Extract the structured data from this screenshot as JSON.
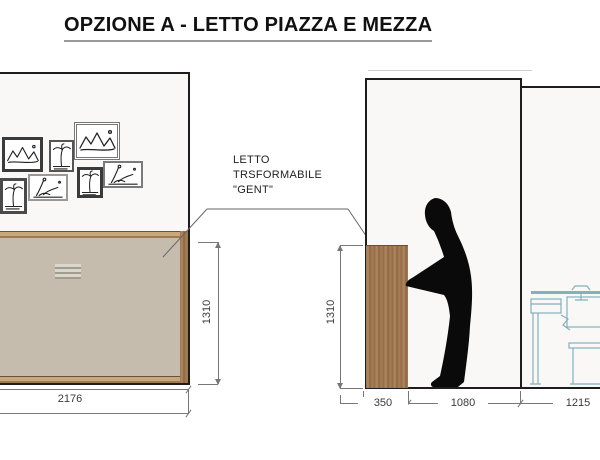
{
  "title": "OPZIONE A - LETTO PIAZZA E MEZZA",
  "annotation": {
    "lines": [
      "LETTO",
      "TRSFORMABILE",
      "\"GENT\""
    ]
  },
  "views": {
    "front_elevation": {
      "description_dims": {
        "width": "2176",
        "height": "1310"
      }
    },
    "side_elevation": {
      "description_dims": {
        "height": "1310",
        "bed_depth": "350",
        "clearance": "1080",
        "right_zone": "1215"
      }
    }
  },
  "dimensions": {
    "front_width": "2176",
    "front_height": "1310",
    "side_height": "1310",
    "side_depth": "350",
    "side_clearance": "1080",
    "side_zone": "1215"
  },
  "icons": {
    "wall_art": "framed-landscape-sketches",
    "person": "standing-person-silhouette",
    "desk": "desk-and-bench-outline"
  },
  "colors": {
    "bed_panel": "#c5bcae",
    "wood": "#a87f55",
    "wall_fill": "#faf8f6",
    "outline": "#1d1d1d",
    "desk_line": "#7fb2bc",
    "dim_line": "#777777"
  }
}
